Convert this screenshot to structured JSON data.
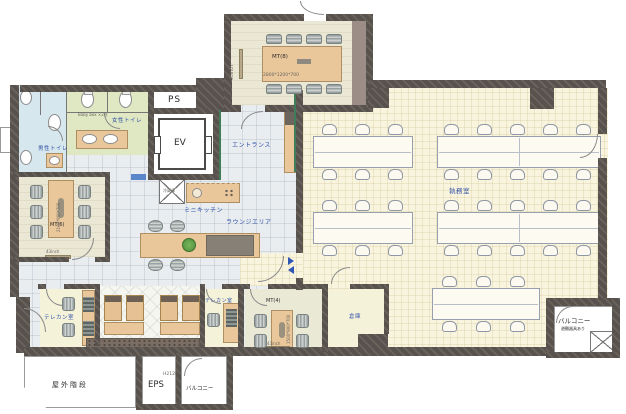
{
  "rooms": {
    "mt8": {
      "label": "MT(8)",
      "table_size": "2800*1200*700",
      "screen": "50inch"
    },
    "mt6": {
      "label": "MT(6)",
      "table_size": "2100*900*700",
      "screen": "43inch"
    },
    "mt4": {
      "label": "MT(4)",
      "table_size": "1500*900*700",
      "screen": "43inch"
    },
    "ps": {
      "label": "PS"
    },
    "ev": {
      "label": "EV"
    },
    "eps": {
      "label": "EPS"
    },
    "entrance": {
      "label": "エントランス"
    },
    "womens_toilet": {
      "label": "女性トイレ",
      "note": "Baby box ×2台"
    },
    "mens_toilet": {
      "label": "男性トイレ"
    },
    "mini_kitchen": {
      "label": "ミニキッチン",
      "fridge": "冷蔵庫"
    },
    "lounge": {
      "label": "ラウンジエリア"
    },
    "office": {
      "label": "執務室"
    },
    "telecom": {
      "label": "テレカン室"
    },
    "storage": {
      "label": "倉庫"
    },
    "balcony": {
      "label": "バルコニー",
      "evac_note": "避難器具あり"
    },
    "outdoor_stairs": {
      "label": "屋外階段"
    },
    "height_note": {
      "label": "H2120"
    }
  },
  "colors": {
    "wall": "#57524e",
    "office_floor": "#f8f4dd",
    "lounge_floor": "#e9edf0",
    "womens_toilet_floor": "#dfe7c3",
    "mens_toilet_floor": "#d7e7ee",
    "table_tan": "#e9c79b",
    "label_blue": "#3252a8",
    "accent_green": "#3f7d5a"
  }
}
